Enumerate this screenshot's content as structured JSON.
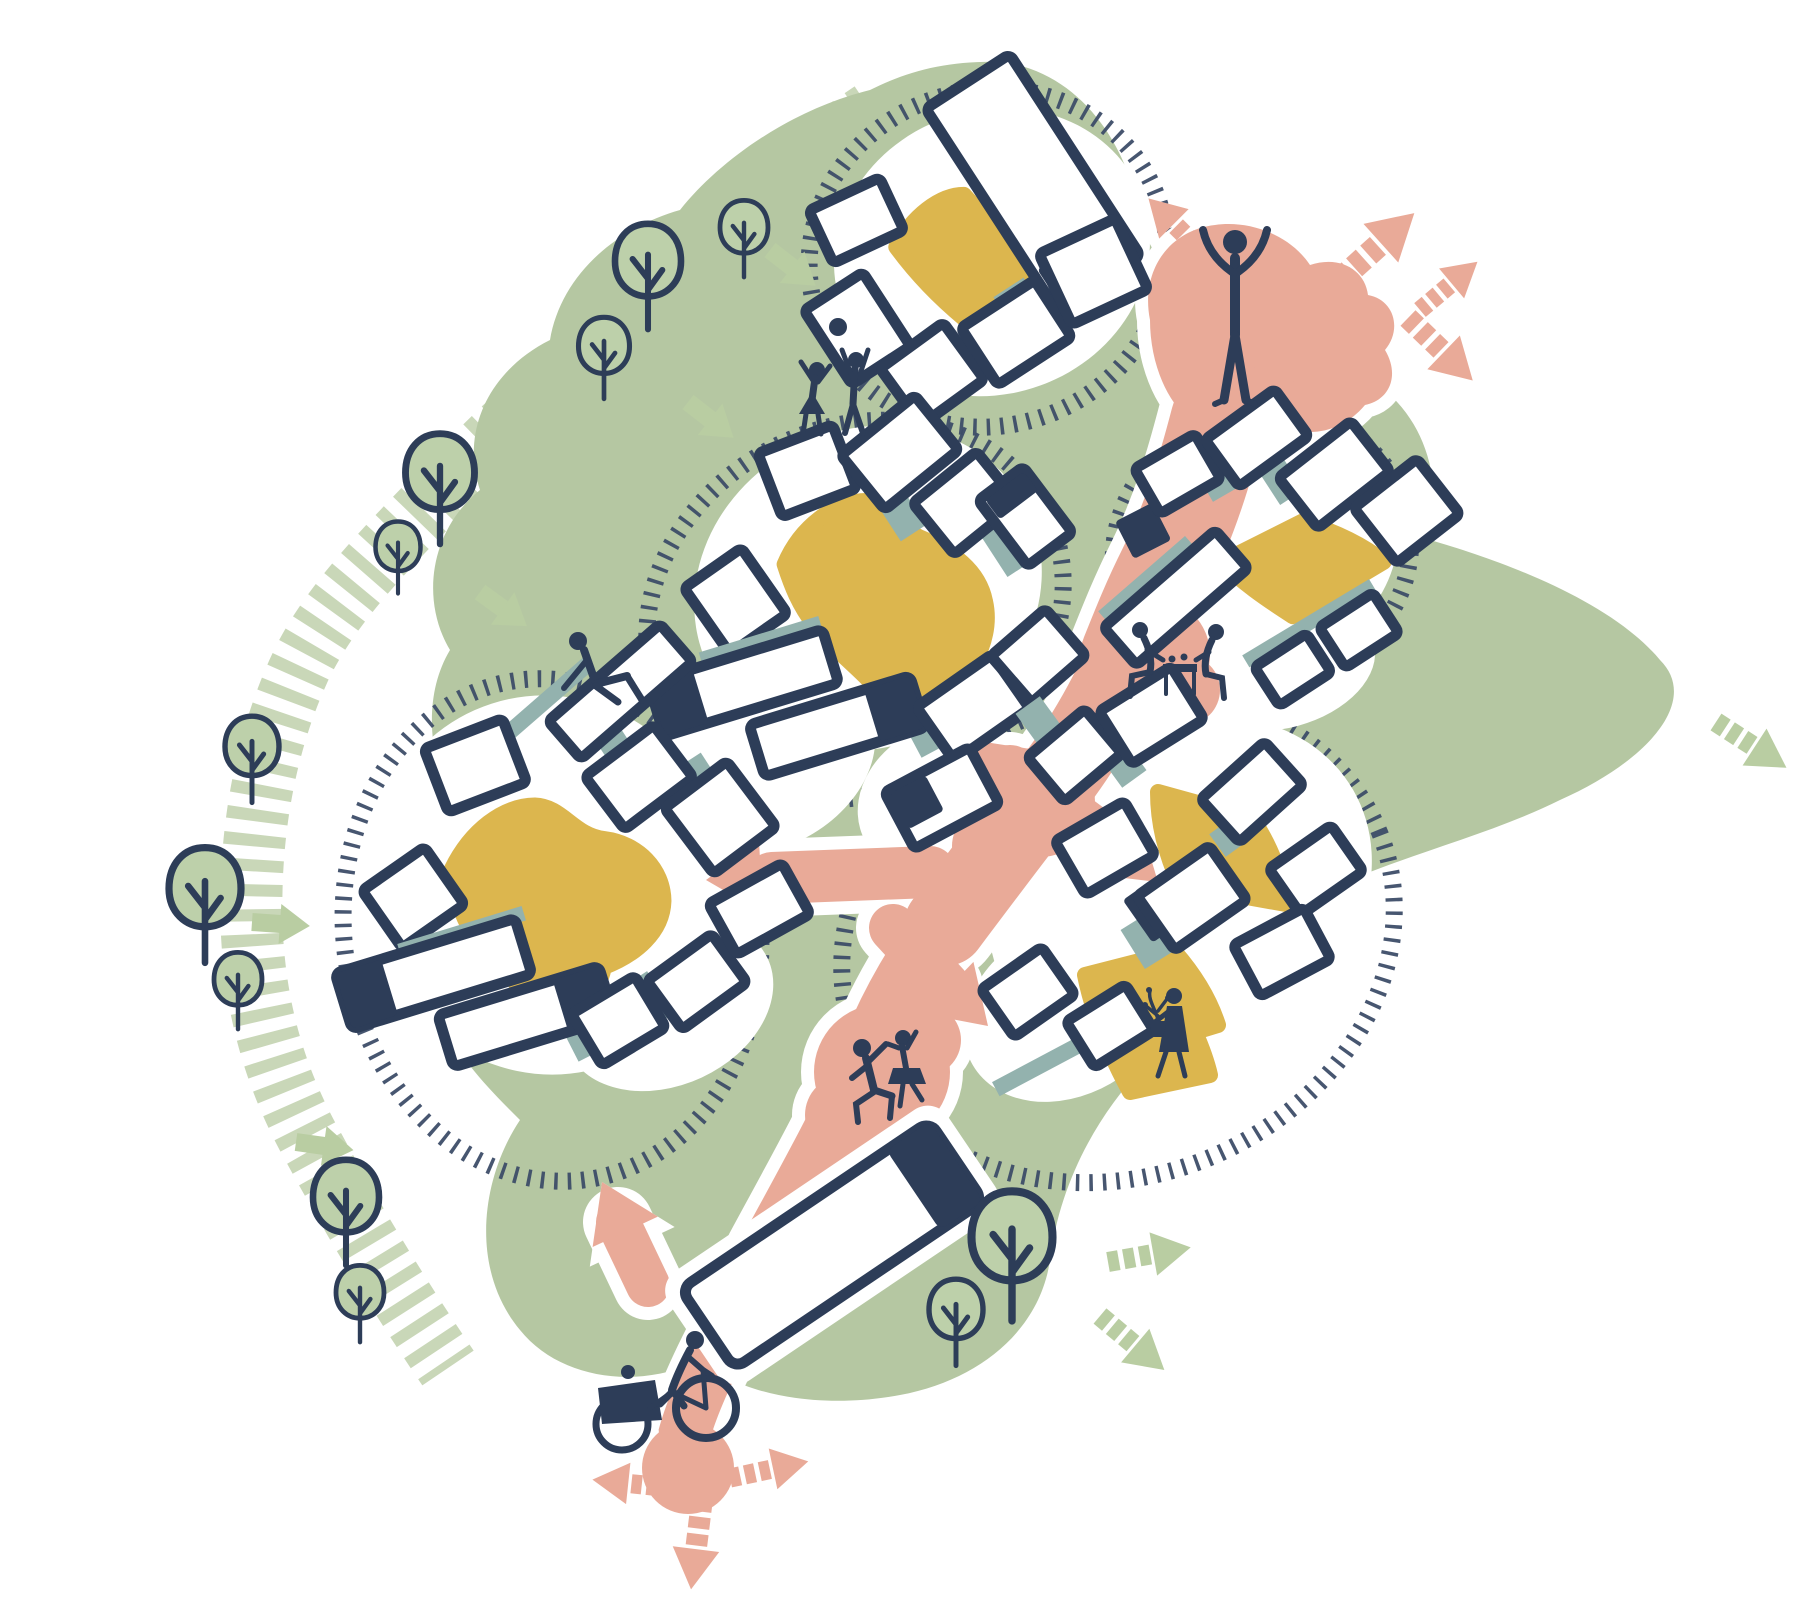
{
  "title": "Neighbourhood masterplan concept diagram",
  "palette": {
    "background": "#ffffff",
    "navy": "#2d3d58",
    "green": "#b5c7a2",
    "green_hatch": "#c9d7b8",
    "green_tree": "#bdd0aa",
    "green_arrow": "#b9cda2",
    "pink": "#e9aa98",
    "yellow": "#dcb64e",
    "teal": "#93b2ae",
    "tick": "#3d4d68"
  },
  "site": {
    "housing_clusters": [
      {
        "name": "cluster-top",
        "center": [
          985,
          255
        ]
      },
      {
        "name": "cluster-right-upper",
        "center": [
          1258,
          548
        ]
      },
      {
        "name": "cluster-middle",
        "center": [
          862,
          588
        ]
      },
      {
        "name": "cluster-right-lower",
        "center": [
          1150,
          890
        ]
      },
      {
        "name": "cluster-left",
        "center": [
          545,
          880
        ]
      }
    ],
    "standalone_buildings": [
      {
        "name": "long-building-bottom",
        "center": [
          832,
          1245
        ]
      },
      {
        "name": "corner-building",
        "center": [
          942,
          798
        ]
      }
    ],
    "figures": [
      {
        "name": "person-arms-raised",
        "position": [
          1235,
          300
        ]
      },
      {
        "name": "ball-players",
        "position": [
          835,
          390
        ]
      },
      {
        "name": "person-sitting",
        "position": [
          600,
          670
        ]
      },
      {
        "name": "picnic-pair-at-table",
        "position": [
          1178,
          662
        ]
      },
      {
        "name": "dancing-couple",
        "position": [
          885,
          1075
        ]
      },
      {
        "name": "woman-with-plant",
        "position": [
          1170,
          1040
        ]
      },
      {
        "name": "cargo-bike-rider",
        "position": [
          668,
          1385
        ]
      }
    ],
    "trees": {
      "count": 12
    },
    "path_network": {
      "pedestrian_spine_color": "pink",
      "greenway_edge": "hatched band with trees",
      "pink_dashed_arrows": 7,
      "green_dashed_arrows": 3,
      "green_solid_arrows": 5,
      "pink_branch_arrows": 6,
      "dotted_cluster_boundaries": 5
    }
  }
}
